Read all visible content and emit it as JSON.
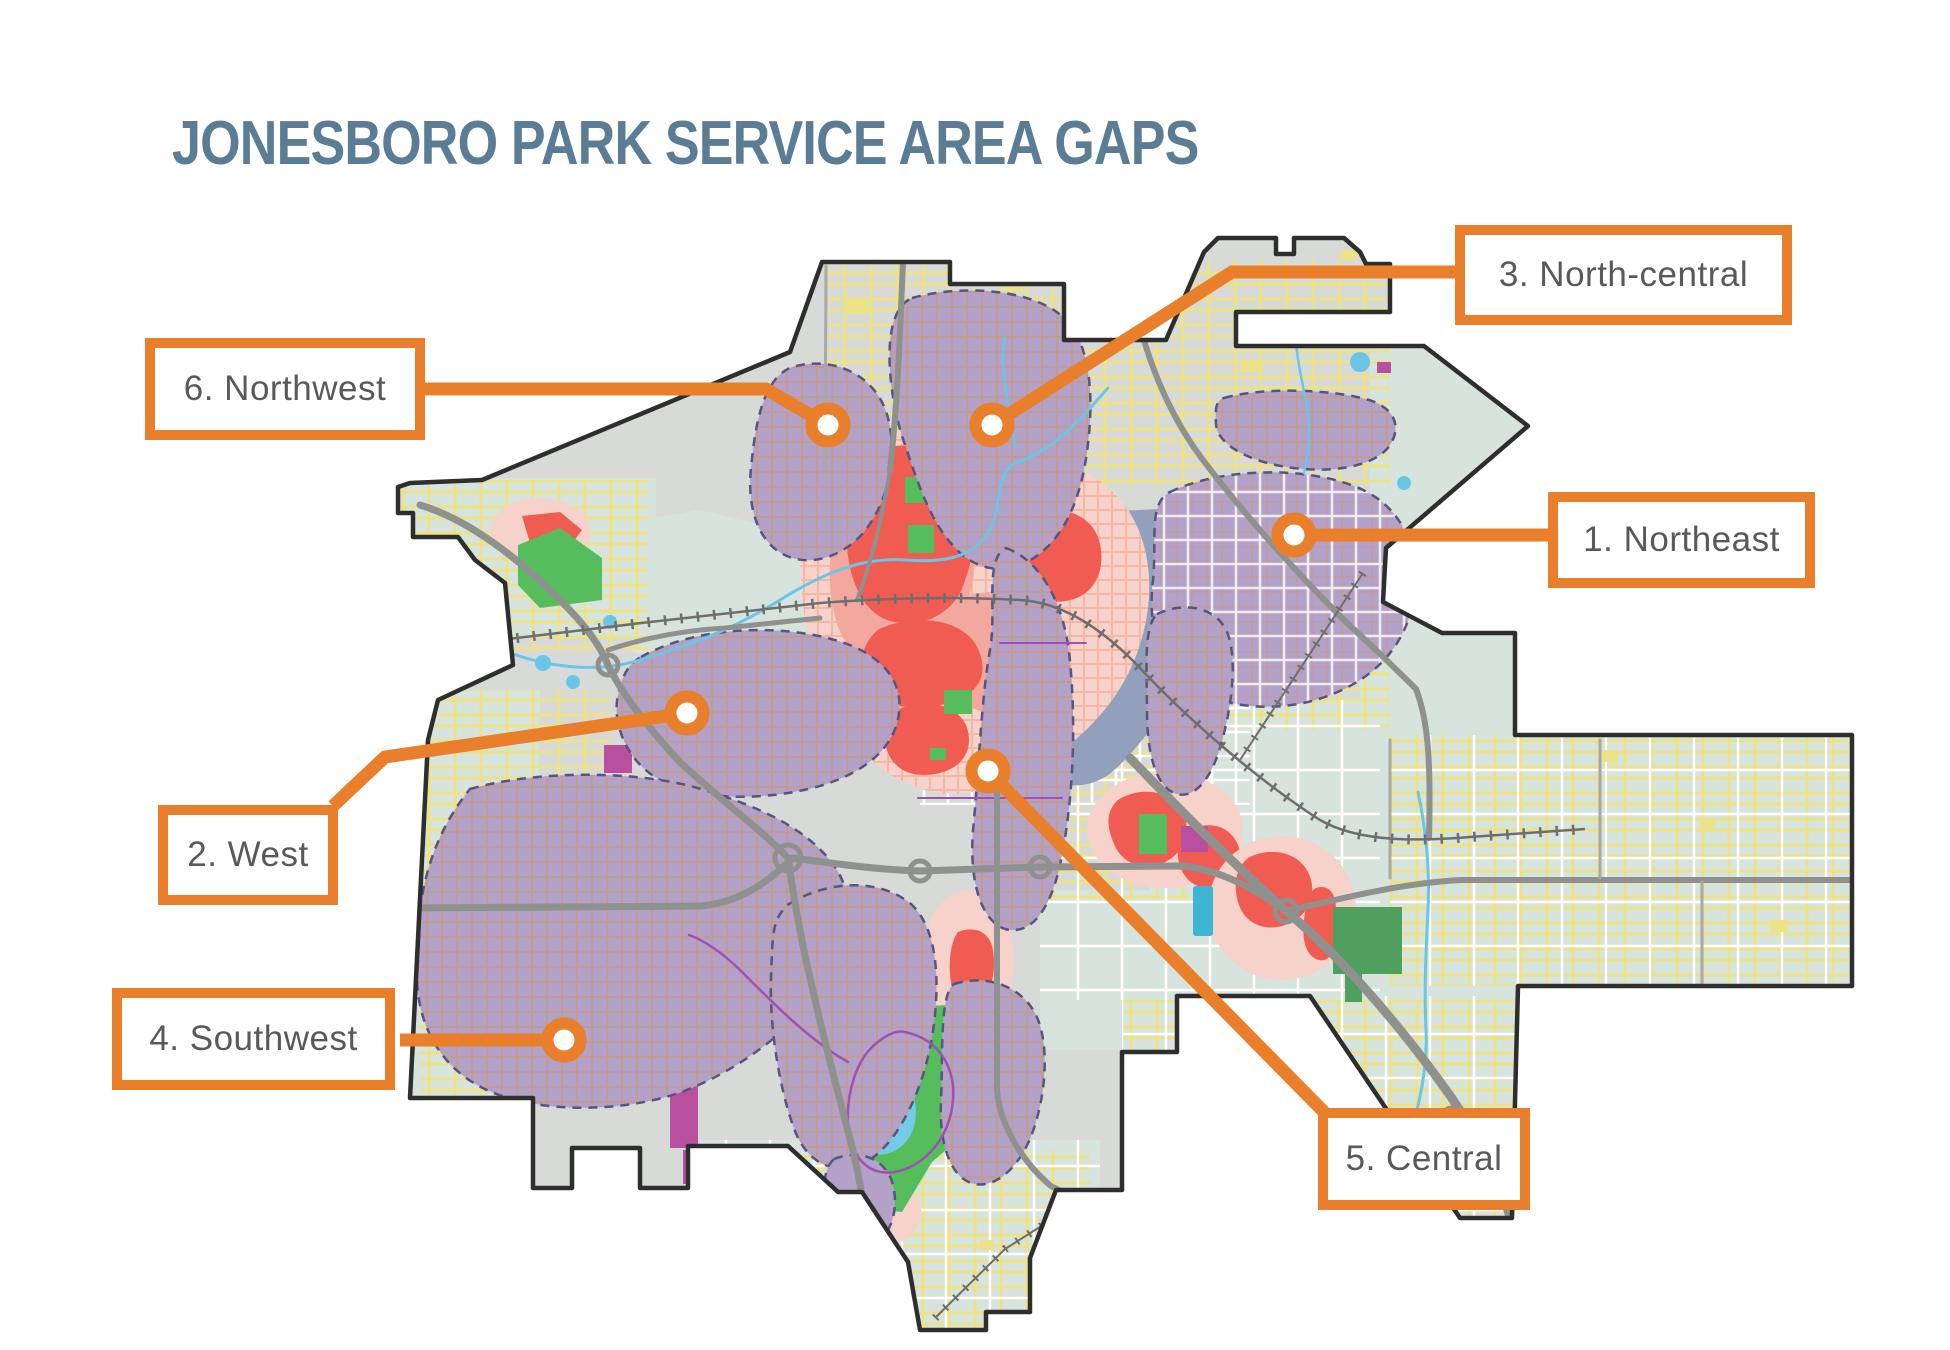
{
  "title": {
    "text": "JONESBORO PARK SERVICE AREA GAPS"
  },
  "callouts": {
    "northeast": {
      "label": "1. Northeast"
    },
    "west": {
      "label": "2. West"
    },
    "north_central": {
      "label": "3. North-central"
    },
    "southwest": {
      "label": "4. Southwest"
    },
    "central": {
      "label": "5. Central"
    },
    "northwest": {
      "label": "6. Northwest"
    }
  },
  "map": {
    "colors": {
      "accent_orange": "#E97E2B",
      "title_blue": "#5A7D95",
      "label_text_gray": "#59595C",
      "city_base_gray": "#D8DAD7",
      "overlay_teal": "#D7E3DD",
      "gap_purple": "#B3A1C7",
      "gap_dash_border": "#55557E",
      "heat_red": "#F15C52",
      "heat_pink": "#F6D2CB",
      "park_green": "#55BD5B",
      "park_green_dark": "#4FA05F",
      "water_blue": "#6AC6E6",
      "slate_blue": "#92A0BD",
      "magenta": "#B9509F",
      "trail_purple": "#A050B4",
      "street_yellow": "#ECE287",
      "road_gray": "#8E918E",
      "boundary_dark": "#2E2E2E"
    }
  }
}
